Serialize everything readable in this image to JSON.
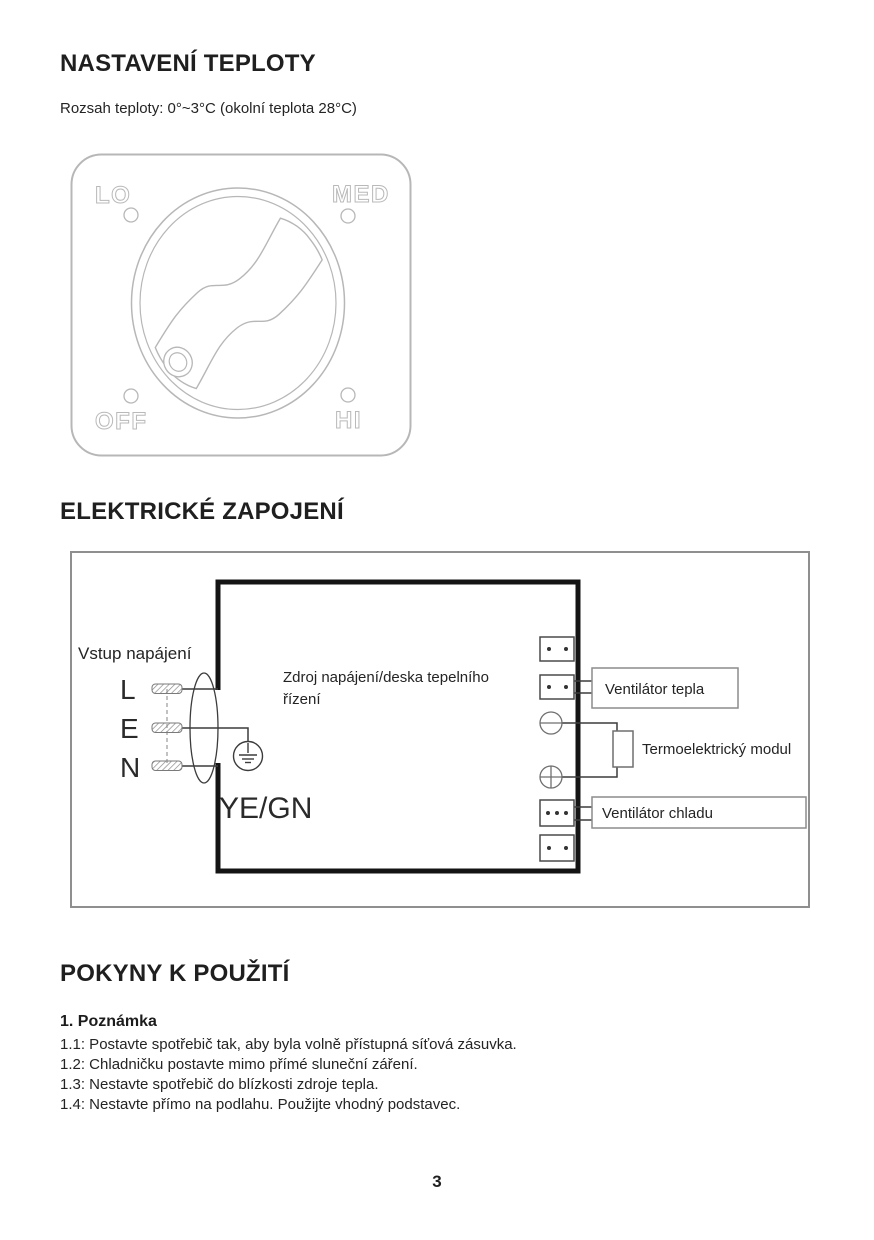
{
  "document": {
    "page_number": "3"
  },
  "temperature_section": {
    "heading": "NASTAVENÍ TEPLOTY",
    "range_text": "Rozsah teploty: 0°~3°C (okolní teplota 28°C)",
    "dial": {
      "pos_lo": "LO",
      "pos_med": "MED",
      "pos_off": "OFF",
      "pos_hi": "HI"
    }
  },
  "wiring_section": {
    "heading": "ELEKTRICKÉ ZAPOJENÍ",
    "power_input_label": "Vstup napájení",
    "terminal_l": "L",
    "terminal_e": "E",
    "terminal_n": "N",
    "wire_color_label": "YE/GN",
    "board_label_line1": "Zdroj napájení/deska tepelního",
    "board_label_line2": "řízení",
    "fan_heat_label": "Ventilátor tepla",
    "thermo_module_label": "Termoelektrický modul",
    "fan_cool_label": "Ventilátor chladu"
  },
  "instructions_section": {
    "heading": "POKYNY K POUŽITÍ",
    "note_heading": "1. Poznámka",
    "items": [
      "1.1: Postavte spotřebič tak, aby byla volně přístupná síťová zásuvka.",
      "1.2: Chladničku postavte mimo přímé sluneční záření.",
      "1.3: Nestavte spotřebič do blízkosti zdroje tepla.",
      "1.4: Nestavte přímo na podlahu. Použijte vhodný podstavec."
    ]
  },
  "colors": {
    "text": "#1f1f1f",
    "dial_stroke": "#b7b7b7",
    "wire_stroke": "#3c3c3c",
    "board_stroke": "#141414",
    "frame_stroke": "#8f8f8f",
    "label_box_stroke": "#8c8c8c"
  }
}
